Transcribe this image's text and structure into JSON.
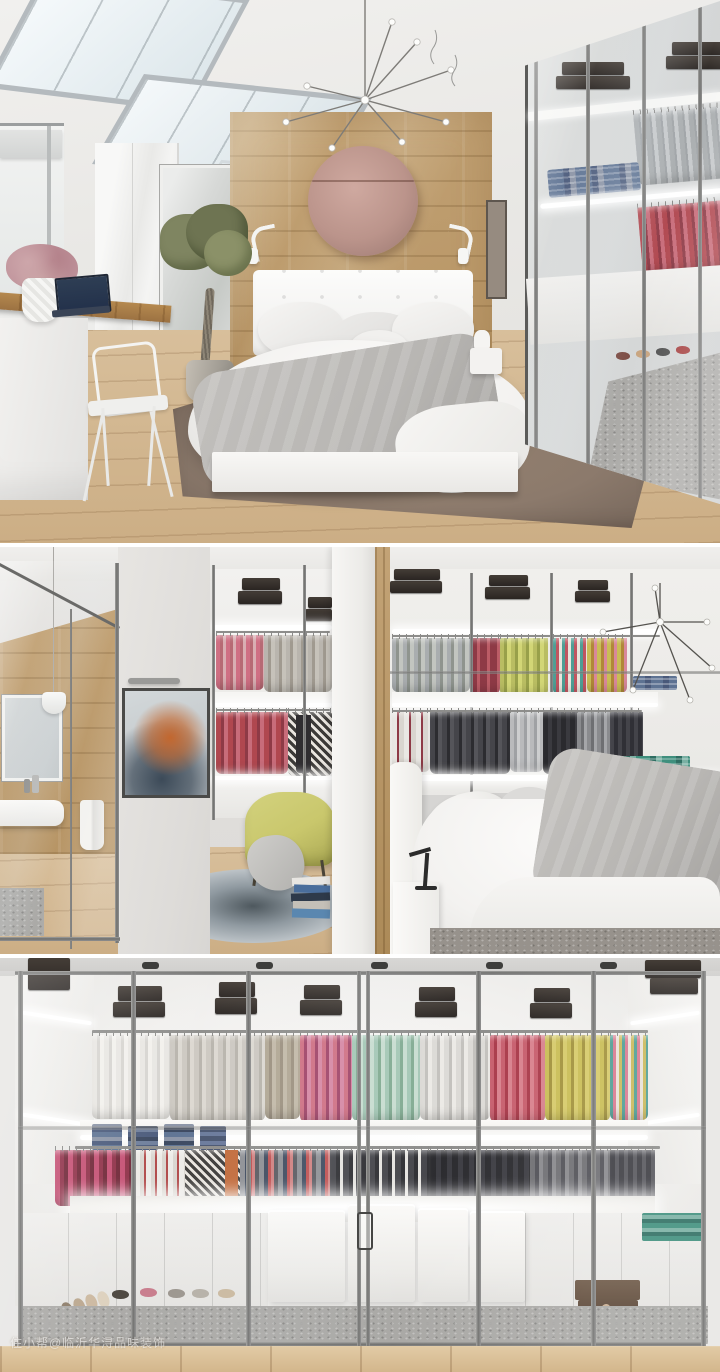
{
  "watermark": {
    "text": "住小帮@临沂华浔品味装饰"
  },
  "colors": {
    "wall": "#e8e6e3",
    "ceiling": "#f2f1ef",
    "skylight": "#eaf1f5",
    "glassFrame": "#77787a",
    "woodWall": "#c3a376",
    "woodFloor": "#d8bf9b",
    "disc": "#bb948b",
    "bedding": "#f3f2f0",
    "blanket": "#b8b6b3",
    "rugBrown": "#8c7a6c",
    "rugRound": "#8f99a0",
    "rugSpeckle": "#a9a8a5",
    "clothesGrey": "#a9adaf",
    "clothesPink": "#cf6f83",
    "clothesRed": "#b0474f",
    "clothesBurgundy": "#8e3a46",
    "clothesYellow": "#c9bd55",
    "clothesLime": "#b9bd62",
    "clothesMint": "#a4c7b5",
    "clothesFuchsia": "#c44e72",
    "clothesCharcoal": "#45454a",
    "clothesBlack": "#2a2a2e",
    "denim": "#5d7292",
    "boxBlack": "#2a2522",
    "boxBrown": "#5f4a39",
    "chairYellow": "#c9c76c",
    "artOrange": "#c2672f",
    "artNavy": "#3c4a58",
    "ledWhite": "#ffffff"
  }
}
